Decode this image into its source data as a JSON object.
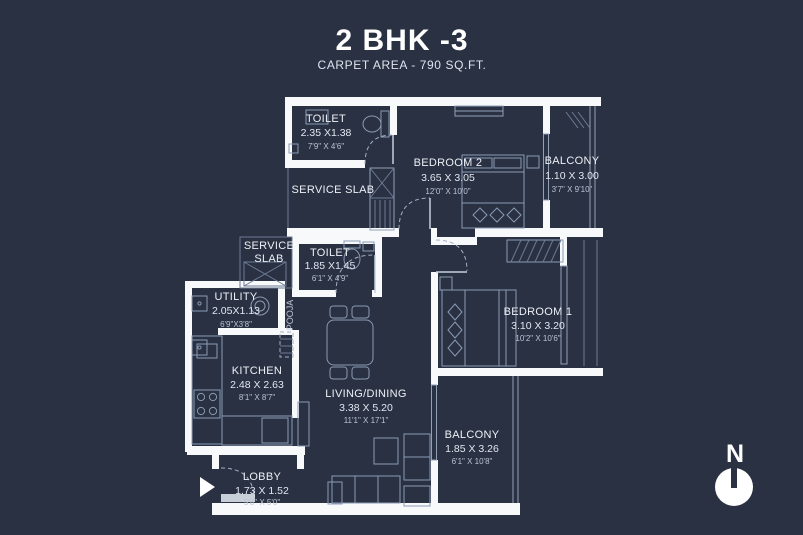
{
  "header": {
    "title": "2 BHK -3",
    "subtitle": "CARPET AREA - 790 SQ.FT."
  },
  "colors": {
    "background": "#293142",
    "wall": "#f7f9fb",
    "line": "#92a1ba",
    "text": "#edf1f7"
  },
  "compass": {
    "label": "N"
  },
  "rooms": {
    "toilet_top": {
      "name": "TOILET",
      "metric": "2.35 X1.38",
      "imperial": "7'9\" X 4'6\""
    },
    "bedroom2": {
      "name": "BEDROOM 2",
      "metric": "3.65 X 3.05",
      "imperial": "12'0\" X 10'0\""
    },
    "balcony_top": {
      "name": "BALCONY",
      "metric": "1.10 X 3.00",
      "imperial": "3'7\" X 9'10\""
    },
    "service_slab_top": {
      "name": "SERVICE SLAB"
    },
    "service_slab_left": {
      "line1": "SERVICE",
      "line2": "SLAB"
    },
    "toilet_mid": {
      "name": "TOILET",
      "metric": "1.85 X1.45",
      "imperial": "6'1\" X 4'9\""
    },
    "utility": {
      "name": "UTILITY",
      "metric": "2.05X1.13",
      "imperial": "6'9\"X3'8\""
    },
    "pooja": {
      "name": "POOJA"
    },
    "kitchen": {
      "name": "KITCHEN",
      "metric": "2.48 X 2.63",
      "imperial": "8'1\" X 8'7\""
    },
    "living": {
      "name": "LIVING/DINING",
      "metric": "3.38 X 5.20",
      "imperial": "11'1\" X 17'1\""
    },
    "bedroom1": {
      "name": "BEDROOM 1",
      "metric": "3.10 X 3.20",
      "imperial": "10'2\" X 10'6\""
    },
    "balcony_bottom": {
      "name": "BALCONY",
      "metric": "1.85 X 3.26",
      "imperial": "6'1\" X 10'8\""
    },
    "lobby": {
      "name": "LOBBY",
      "metric": "1.73 X 1.52",
      "imperial": "5'8\" X 5'0\""
    }
  }
}
